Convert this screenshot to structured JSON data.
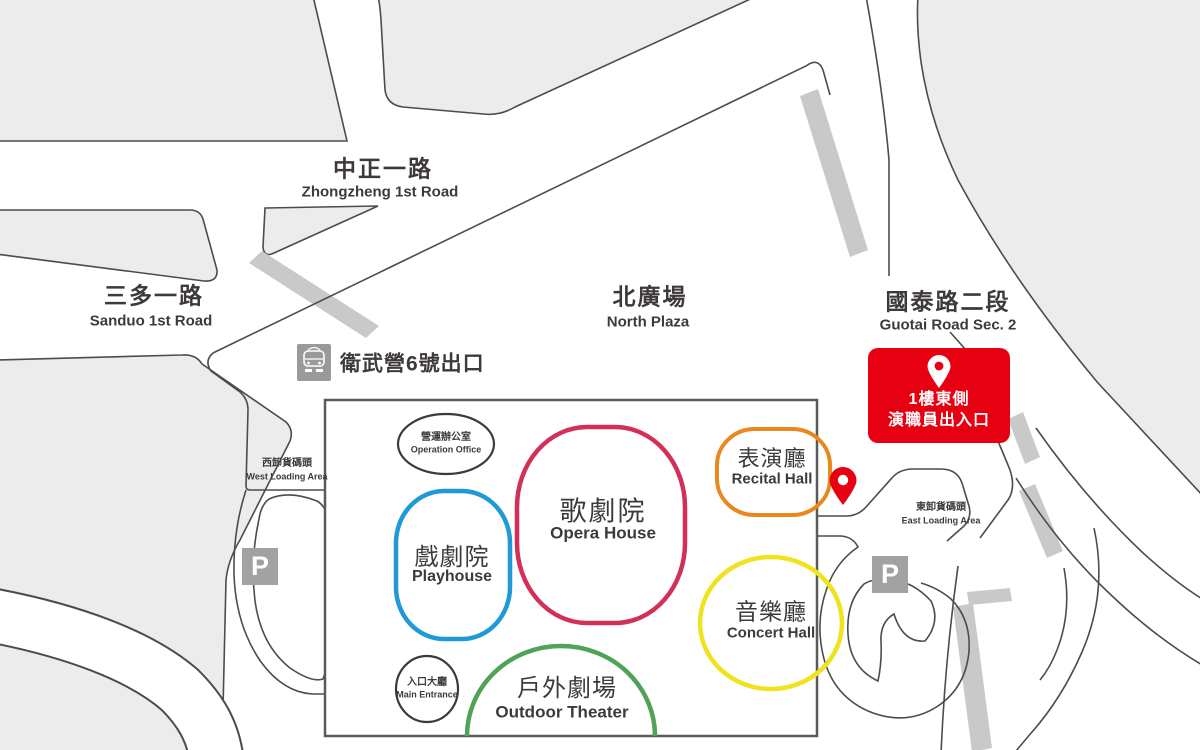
{
  "map": {
    "roads": [
      {
        "zh": "中正一路",
        "en": "Zhongzheng 1st Road"
      },
      {
        "zh": "三多一路",
        "en": "Sanduo 1st Road"
      },
      {
        "zh": "國泰路二段",
        "en": "Guotai Road Sec. 2"
      }
    ],
    "areas": [
      {
        "zh": "北廣場",
        "en": "North Plaza"
      },
      {
        "zh": "西卸貨碼頭",
        "en": "West  Loading Area"
      },
      {
        "zh": "東卸貨碼頭",
        "en": "East Loading Area"
      }
    ],
    "mrt_exit": {
      "label": "衛武營6號出口"
    },
    "venues": {
      "opera": {
        "zh": "歌劇院",
        "en": "Opera House",
        "color": "#d23157"
      },
      "playhouse": {
        "zh": "戲劇院",
        "en": "Playhouse",
        "color": "#1f9ad6"
      },
      "recital": {
        "zh": "表演廳",
        "en": "Recital Hall",
        "color": "#e8881d"
      },
      "concert": {
        "zh": "音樂廳",
        "en": "Concert Hall",
        "color": "#f0e31e"
      },
      "outdoor": {
        "zh": "戶外劇場",
        "en": "Outdoor Theater",
        "color": "#4fa357"
      },
      "operation": {
        "zh": "營運辦公室",
        "en": "Operation Office",
        "color": "#3e3a39"
      },
      "entrance": {
        "zh": "入口大廳",
        "en": "Main Entrance",
        "color": "#3e3a39"
      }
    },
    "badge": {
      "line1": "1樓東側",
      "line2": "演職員出入口",
      "color": "#e60012"
    },
    "parking_label": "P",
    "colors": {
      "block": "#ececec",
      "stripe": "#c9c9ca",
      "road_line": "#4c4c4a",
      "building_line": "#595a5c",
      "pin": "#e60012",
      "icon_gray": "#9a9a9a",
      "text": "#3e3a39"
    }
  }
}
